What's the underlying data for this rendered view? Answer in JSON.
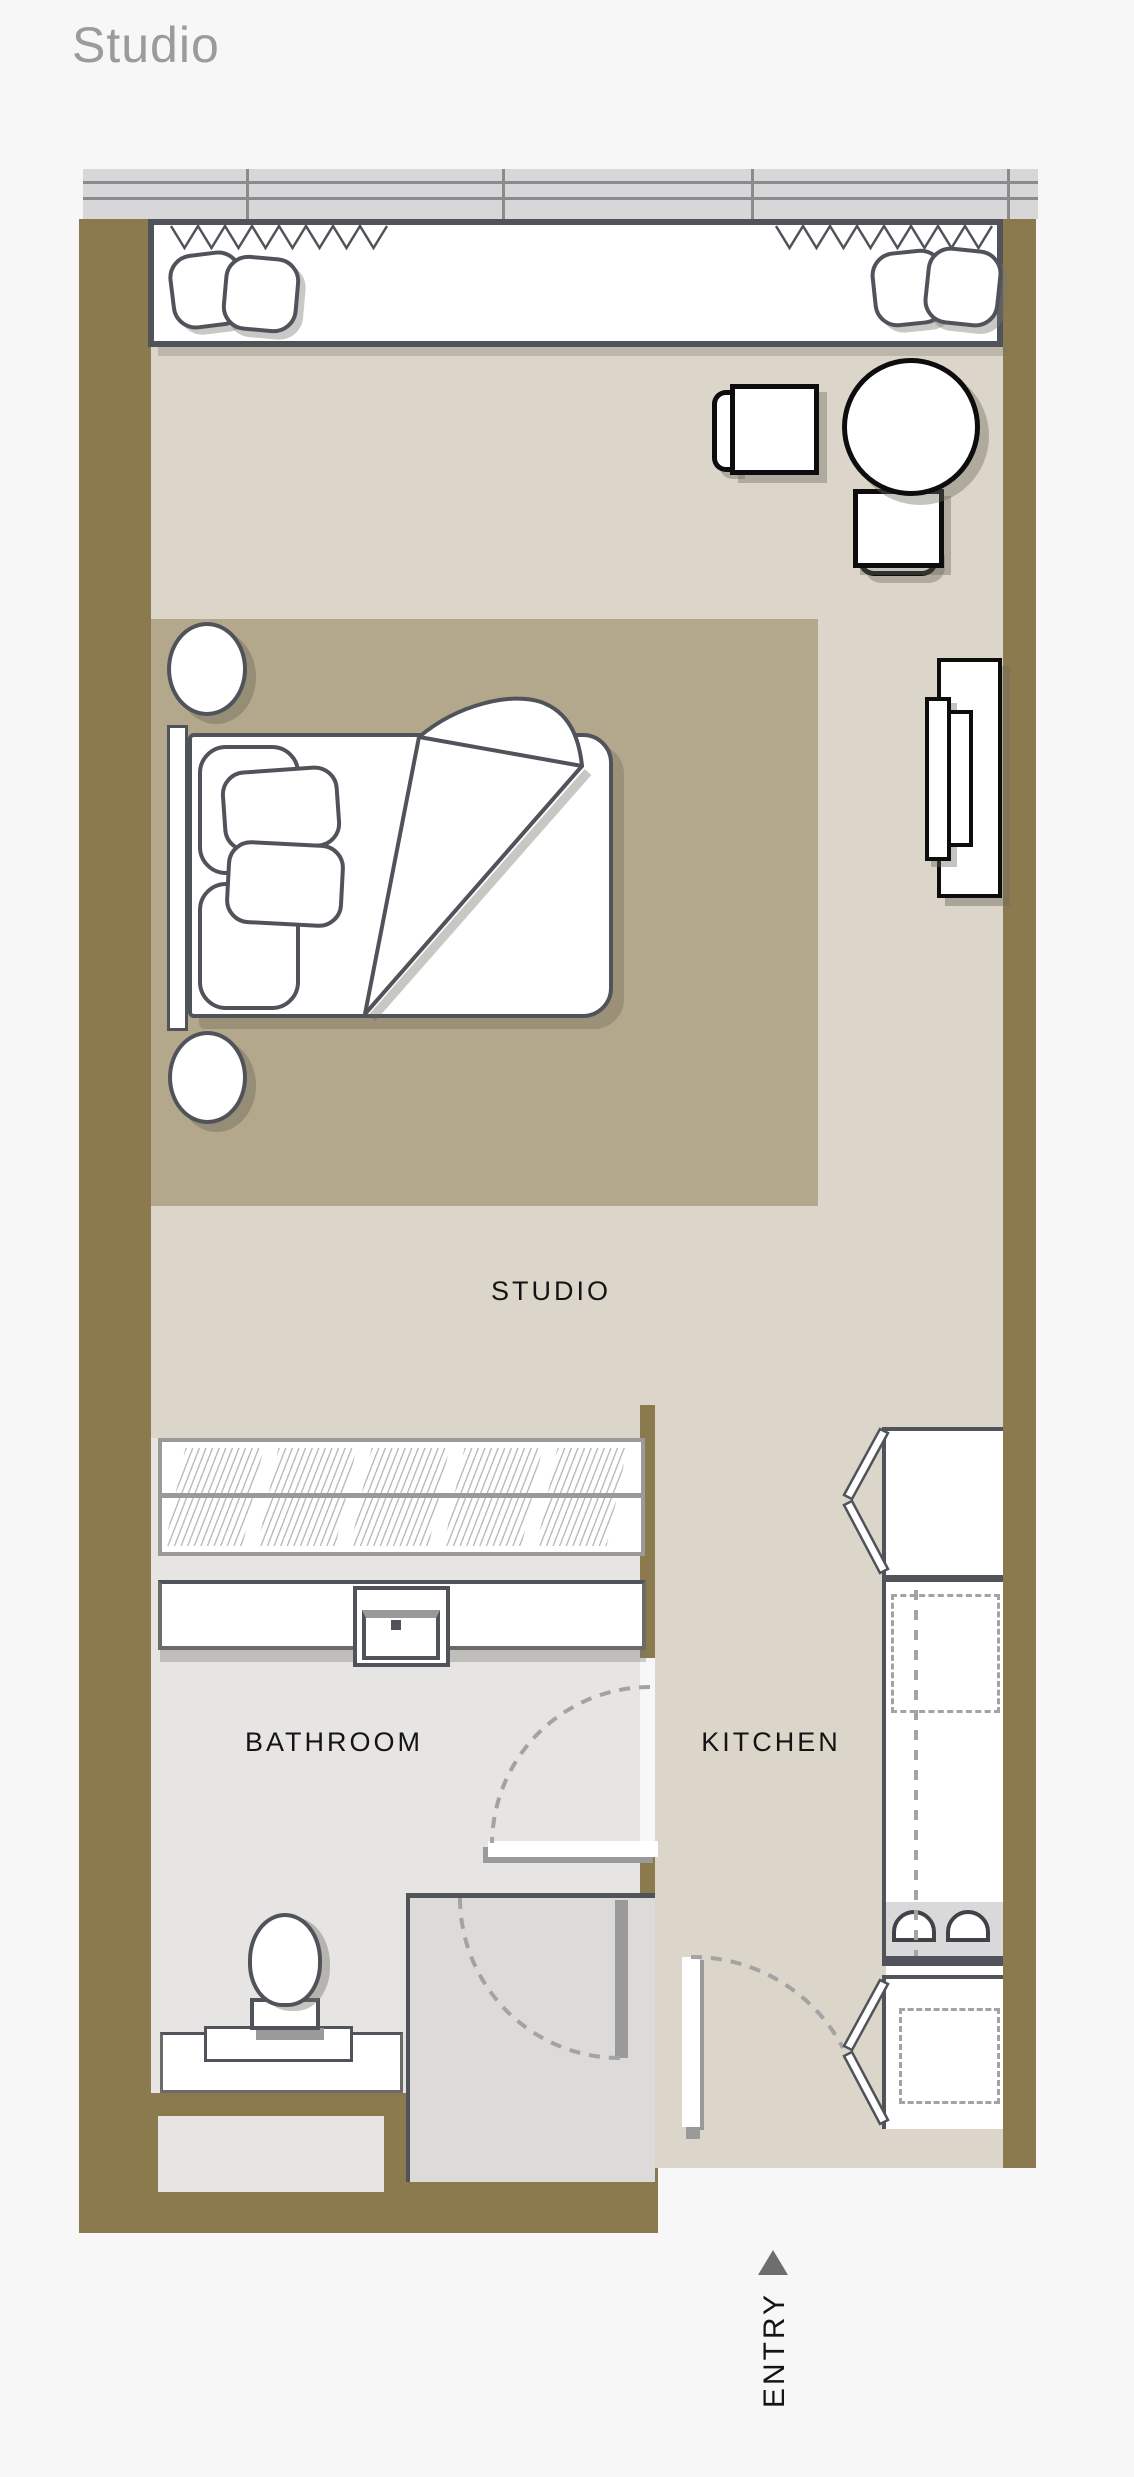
{
  "page": {
    "title": "Studio"
  },
  "plan": {
    "room_labels": {
      "studio": "STUDIO",
      "bathroom": "BATHROOM",
      "kitchen": "KITCHEN",
      "entry": "ENTRY"
    },
    "icons": {
      "entry_arrow": "triangle-up"
    },
    "colors": {
      "wall": "#8a7a4e",
      "studio_floor": "#dcd5c9",
      "rug": "#b3a88c",
      "bathroom_floor": "#e6e5e3",
      "shower_floor": "#dcdbd9",
      "window_band": "#d7d7d9",
      "outline_dark": "#50545a",
      "furniture_outline": "#0d0d0d",
      "dashed_swing": "#a3a3a3",
      "title_text": "#9b9b9b",
      "label_text": "#141414"
    }
  }
}
